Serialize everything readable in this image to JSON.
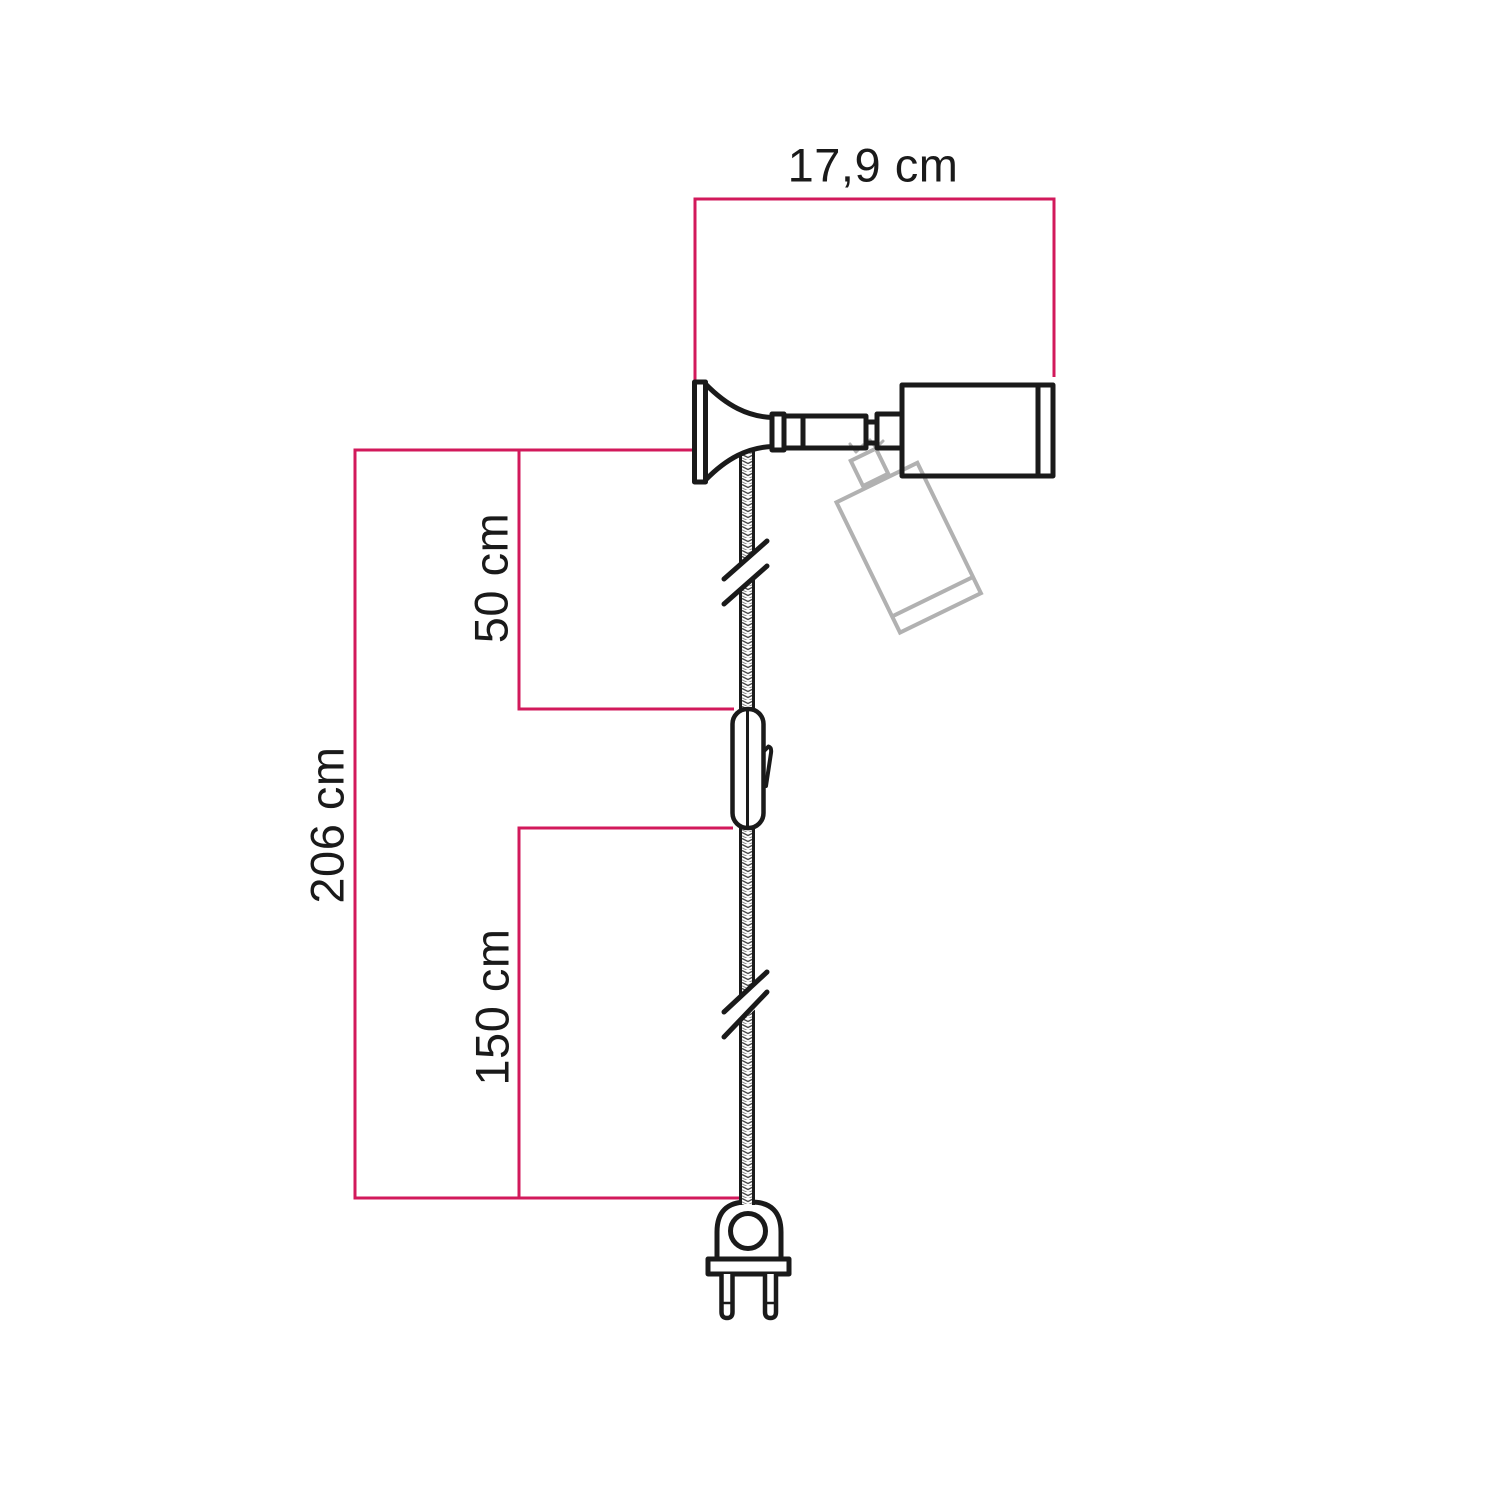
{
  "diagram": {
    "labels": {
      "width": "17,9 cm",
      "total_height": "206 cm",
      "upper_cable": "50 cm",
      "lower_cable": "150 cm"
    },
    "colors": {
      "dimension": "#d2195b",
      "outline": "#1a1a1a",
      "ghost": "#b1b1b1",
      "label_text": "#1a1a1a",
      "background": "#ffffff"
    }
  }
}
